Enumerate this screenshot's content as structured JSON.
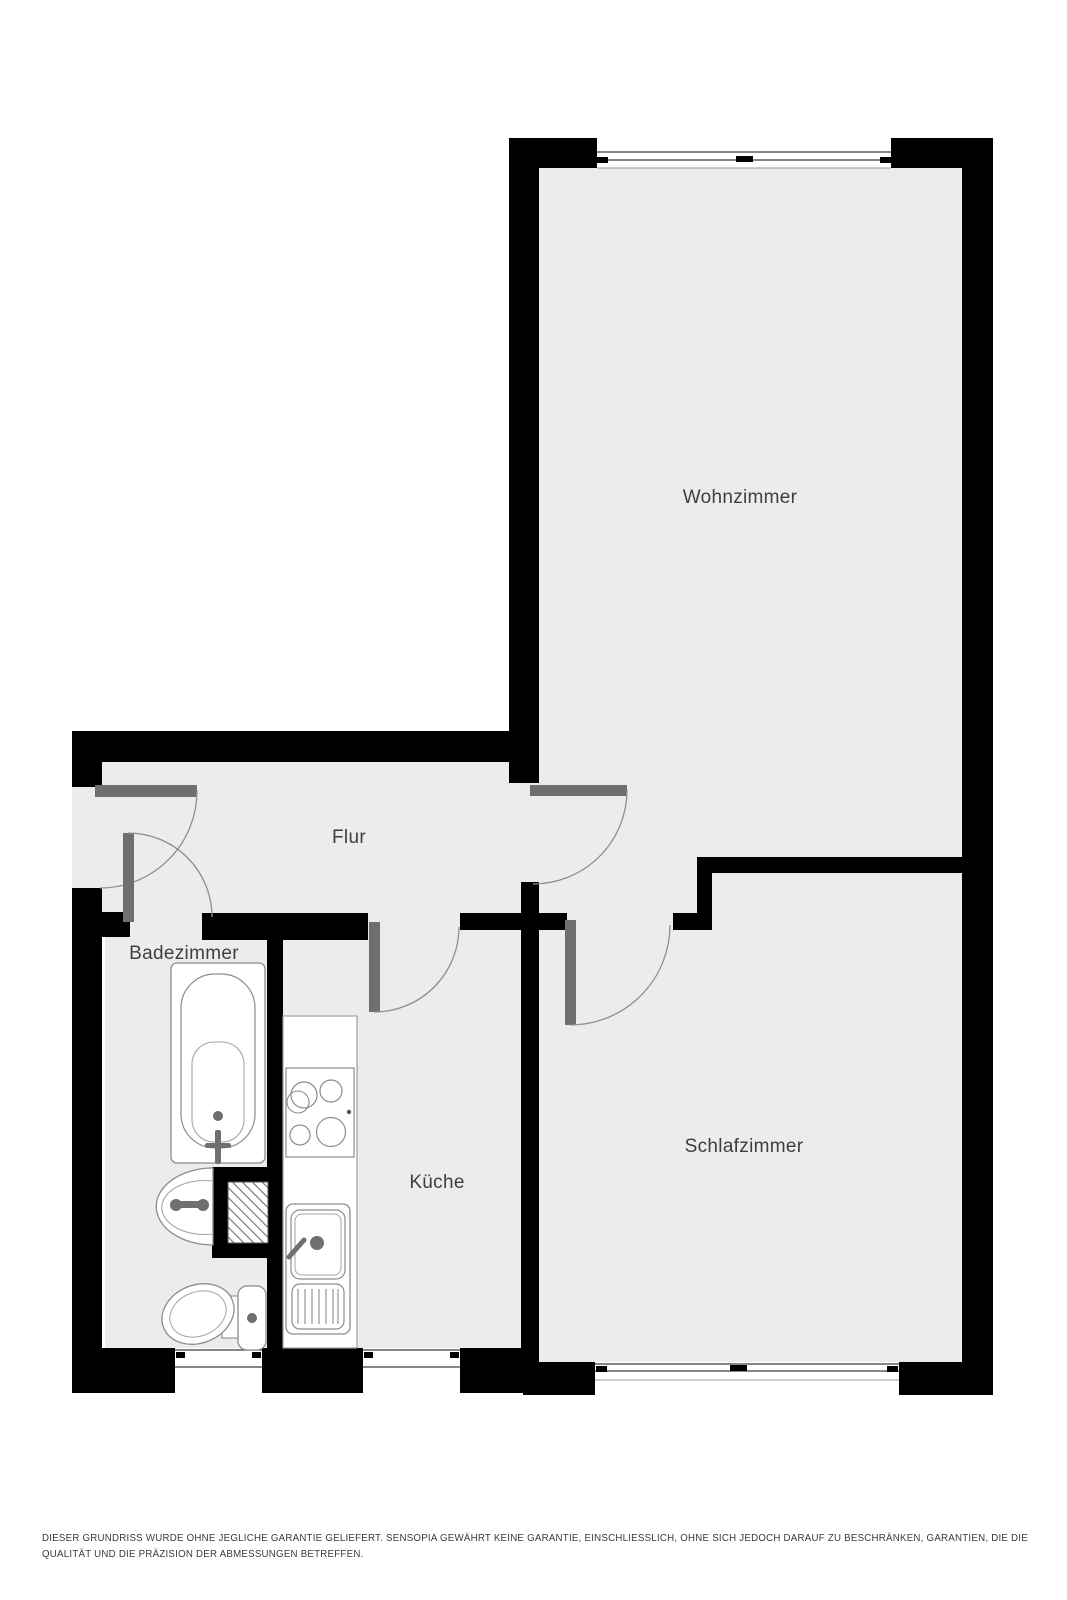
{
  "plan": {
    "type": "apartment-floorplan",
    "language": "de"
  },
  "rooms": [
    {
      "id": "wohnzimmer",
      "label": "Wohnzimmer"
    },
    {
      "id": "flur",
      "label": "Flur"
    },
    {
      "id": "badezimmer",
      "label": "Badezimmer"
    },
    {
      "id": "kueche",
      "label": "Küche"
    },
    {
      "id": "schlafzimmer",
      "label": "Schlafzimmer"
    }
  ],
  "doors": [
    {
      "id": "entrance-door",
      "connects": "outside → Flur"
    },
    {
      "id": "wohnzimmer-door",
      "connects": "Flur → Wohnzimmer"
    },
    {
      "id": "badezimmer-door",
      "connects": "Flur → Badezimmer"
    },
    {
      "id": "kueche-door",
      "connects": "Flur → Küche"
    },
    {
      "id": "schlafzimmer-door",
      "connects": "Flur → Schlafzimmer"
    }
  ],
  "windows": [
    {
      "id": "wohnzimmer-window",
      "wall": "top"
    },
    {
      "id": "badezimmer-window",
      "wall": "bottom"
    },
    {
      "id": "kueche-window",
      "wall": "bottom"
    },
    {
      "id": "schlafzimmer-window",
      "wall": "bottom"
    }
  ],
  "fixtures": [
    {
      "id": "bathtub-icon",
      "room": "badezimmer"
    },
    {
      "id": "washbasin-icon",
      "room": "badezimmer"
    },
    {
      "id": "toilet-icon",
      "room": "badezimmer"
    },
    {
      "id": "shaft-hatch-icon",
      "room": "badezimmer"
    },
    {
      "id": "kitchen-counter",
      "room": "kueche"
    },
    {
      "id": "stove-icon",
      "room": "kueche"
    },
    {
      "id": "kitchen-sink-icon",
      "room": "kueche"
    }
  ],
  "colors": {
    "background": "#ffffff",
    "wall": "#000000",
    "floor": "#ececec",
    "door_leaf": "#6f6f6f",
    "door_arc": "#8f8f8f",
    "window_line": "#3f3f3f",
    "fixture_stroke": "#8c8c8c",
    "label_text": "#3e3e3e",
    "disclaimer_text": "#3a3a3a"
  },
  "disclaimer": {
    "lines": [
      "DIESER GRUNDRISS WURDE OHNE JEGLICHE GARANTIE GELIEFERT. SENSOPIA GEWÄHRT KEINE GARANTIE, EINSCHLIESSLICH, OHNE SICH JEDOCH DARAUF ZU BESCHRÄNKEN, GARANTIEN, DIE DIE",
      "QUALITÄT UND DIE PRÄZISION DER ABMESSUNGEN BETREFFEN."
    ]
  }
}
